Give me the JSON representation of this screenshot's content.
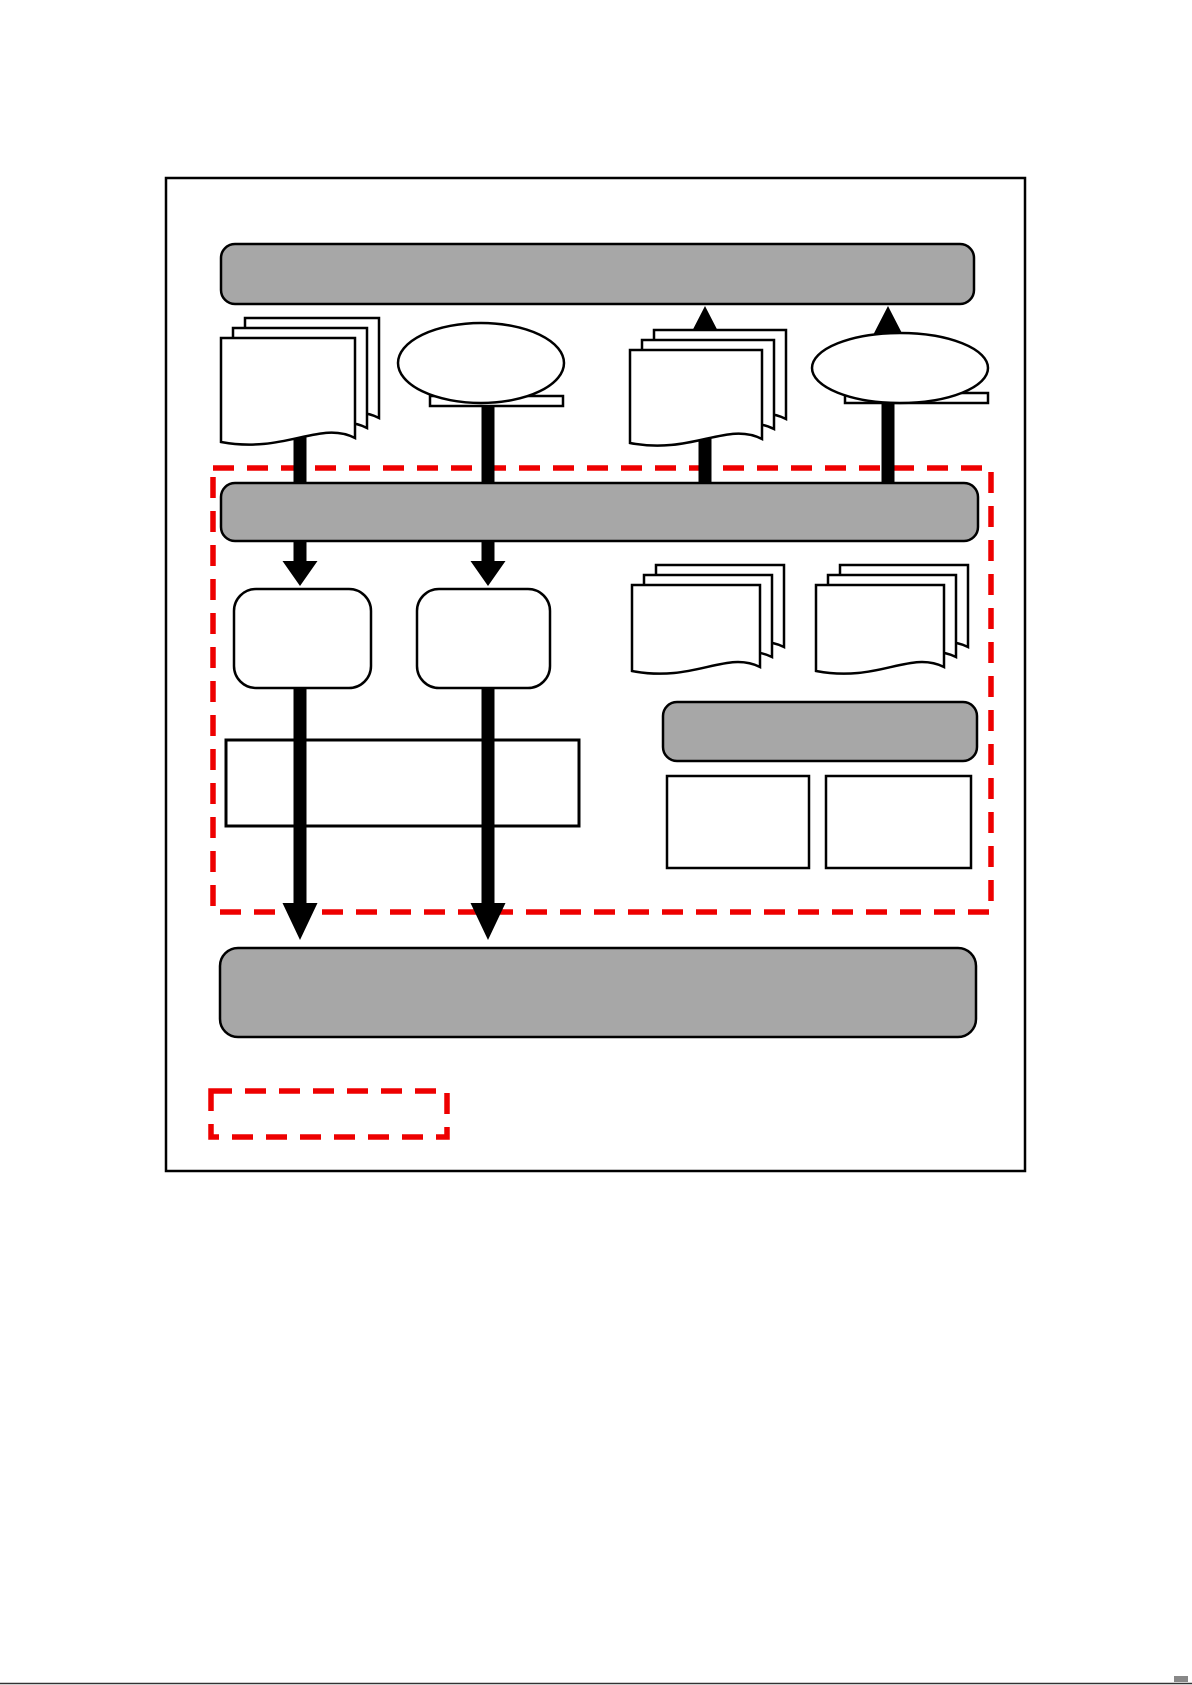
{
  "page": {
    "background": "#ffffff"
  },
  "colors": {
    "outline": "#000000",
    "bar_fill": "#a7a7a7",
    "shape_fill": "#ffffff",
    "arrow_fill": "#000000",
    "highlight_red": "#ee0000",
    "bottom_edge_line": "#333333",
    "bottom_edge_nub": "#888888"
  },
  "diagram": {
    "kind": "flowchart-schematic",
    "has_text_labels": false,
    "outer_frame": {
      "name": "outer-frame",
      "kind": "rectangle-border"
    },
    "bars": [
      {
        "name": "top-process-bar",
        "kind": "rounded-bar",
        "fill": "#a7a7a7",
        "label": ""
      },
      {
        "name": "middle-process-bar",
        "kind": "rounded-bar",
        "fill": "#a7a7a7",
        "label": ""
      },
      {
        "name": "sub-process-bar",
        "kind": "rounded-bar",
        "fill": "#a7a7a7",
        "label": ""
      },
      {
        "name": "bottom-process-bar",
        "kind": "rounded-bar",
        "fill": "#a7a7a7",
        "label": ""
      }
    ],
    "document_stacks": [
      {
        "name": "document-stack-1",
        "pages": 3,
        "position": "top-left",
        "label": ""
      },
      {
        "name": "document-stack-2",
        "pages": 3,
        "position": "top-right-of-center",
        "label": ""
      },
      {
        "name": "document-stack-3",
        "pages": 3,
        "position": "middle-right",
        "label": ""
      },
      {
        "name": "document-stack-4",
        "pages": 3,
        "position": "middle-far-right",
        "label": ""
      }
    ],
    "speech_bubbles": [
      {
        "name": "speech-bubble-1",
        "kind": "oval-callout",
        "position": "top-center-left",
        "label": ""
      },
      {
        "name": "speech-bubble-2",
        "kind": "oval-callout",
        "position": "top-far-right",
        "label": ""
      }
    ],
    "boxes": [
      {
        "name": "rounded-box-1",
        "kind": "rounded-rectangle",
        "fill": "#ffffff",
        "label": ""
      },
      {
        "name": "rounded-box-2",
        "kind": "rounded-rectangle",
        "fill": "#ffffff",
        "label": ""
      },
      {
        "name": "merge-box",
        "kind": "wide-rectangle",
        "fill": "#ffffff",
        "label": ""
      },
      {
        "name": "output-box-1",
        "kind": "rectangle",
        "fill": "#ffffff",
        "label": ""
      },
      {
        "name": "output-box-2",
        "kind": "rectangle",
        "fill": "#ffffff",
        "label": ""
      }
    ],
    "arrows": {
      "down_connectors_into_middle_bar": 2,
      "up_arrows_into_top_bar": 2,
      "down_arrows_from_middle_bar": 2,
      "long_down_arrows_to_bottom_bar": 2,
      "fill": "#000000"
    },
    "highlight_region": {
      "name": "highlight-region",
      "kind": "dashed-rectangle",
      "stroke": "#ee0000",
      "label": ""
    },
    "legend": {
      "name": "legend-dashed-box",
      "kind": "dashed-rectangle",
      "stroke": "#ee0000",
      "label": ""
    }
  }
}
